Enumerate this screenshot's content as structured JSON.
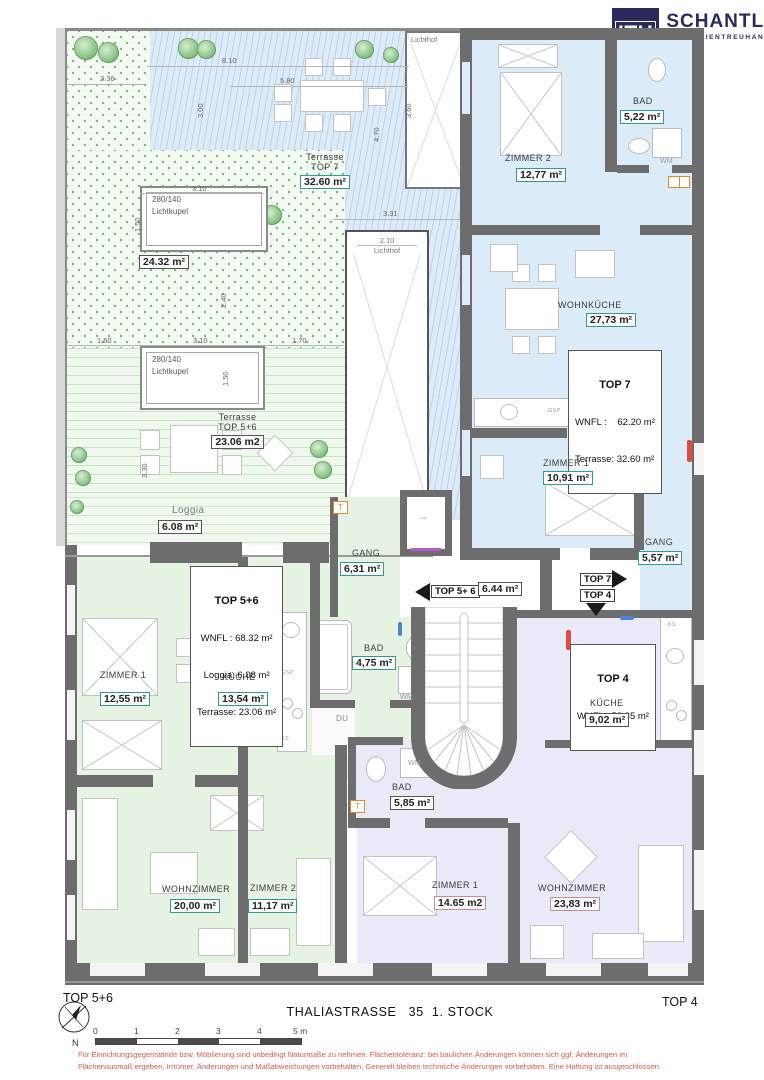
{
  "colors": {
    "wall": "#6d6d6d",
    "accent_teal": "#2f9a95",
    "logo_navy": "#2a2a5c",
    "top7_fill": "#dcebf8",
    "top56_fill": "#e6f3e3",
    "top4_fill": "#e9e9f7",
    "disclaimer_red": "#d95b52"
  },
  "logo": {
    "mark": "ITH",
    "name": "SCHANTL",
    "tagline": "IMMOBILIENTREUHAND"
  },
  "outdoor": {
    "terrasse7": {
      "line1": "Terrasse",
      "line2": "TOP 7",
      "area": "32.60 m²"
    },
    "garden_area": "24.32 m²",
    "lichtkupel1": {
      "size": "280/140",
      "name": "Lichtkupel"
    },
    "lichtkupel2": {
      "size": "280/140",
      "name": "Lichtkupel"
    },
    "lichthof1": "Lichthof",
    "lichthof2": {
      "width": "2.10",
      "name": "Lichthof"
    },
    "terrasse56": {
      "line1": "Terrasse",
      "line2": "TOP 5+6",
      "area": "23.06 m2"
    },
    "loggia": {
      "name": "Loggia",
      "area": "6.08 m²"
    }
  },
  "dims": {
    "garden_w": "2.36",
    "terr_w": "8.10",
    "table_w": "5.80",
    "terr_h": "3.00",
    "terr_h2": "4.70",
    "lh1_h": "3.60",
    "lk1_w": "3.10",
    "lk1_h": "1.50",
    "gap_h": "2.40",
    "row_l": "1.60",
    "row_m": "3.10",
    "row_r": "1.70",
    "lk2_h": "1.50",
    "right_w": "3.31",
    "terr56_h": "3.30"
  },
  "top7": {
    "info": {
      "title": "TOP 7",
      "wnfl": "WNFL :    62.20 m²",
      "terrasse": "Terrasse: 32.60 m²"
    },
    "zimmer2": {
      "label": "ZIMMER 2",
      "area": "12,77 m²"
    },
    "bad": {
      "label": "BAD",
      "area": "5,22 m²"
    },
    "wohnkueche": {
      "label": "WOHNKÜCHE",
      "area": "27,73 m²"
    },
    "zimmer1": {
      "label": "ZIMMER 1",
      "area": "10,91 m²"
    },
    "gang": {
      "label": "GANG",
      "area": "5,57 m²"
    },
    "wm": "WM",
    "gsp": "GSP",
    "ks": "KS"
  },
  "hall": {
    "area": "6.44 m²",
    "nav_left": "TOP 5+ 6",
    "nav_top7": "TOP 7",
    "nav_top4": "TOP 4"
  },
  "top56": {
    "info": {
      "title": "TOP 5+6",
      "wnfl": "WNFL : 68.32 m²",
      "loggia": "Loggia: 6.08 m²",
      "terrasse": "Terrasse: 23.06 m²"
    },
    "gang": {
      "label": "GANG",
      "area": "6,31 m²"
    },
    "zimmer1": {
      "label": "ZIMMER 1",
      "area": "12,55 m²"
    },
    "kueche": {
      "label": "KÜCHE",
      "area": "13,54 m²"
    },
    "bad": {
      "label": "BAD",
      "area": "4,75 m²"
    },
    "wohnzimmer": {
      "label": "WOHNZIMMER",
      "area": "20,00 m²"
    },
    "zimmer2": {
      "label": "ZIMMER 2",
      "area": "11,17 m²"
    },
    "du": "DU",
    "wm": "WM",
    "gsp": "GSP",
    "ks": "KS",
    "t": "T"
  },
  "top4": {
    "info": {
      "title": "TOP 4",
      "wnfl": "WNFL : 53.35 m²"
    },
    "kueche": {
      "label": "KÜCHE",
      "area": "9,02 m²"
    },
    "bad": {
      "label": "BAD",
      "area": "5,85 m²"
    },
    "zimmer1": {
      "label": "ZIMMER 1",
      "area": "14.65 m2"
    },
    "wohnzimmer": {
      "label": "WOHNZIMMER",
      "area": "23,83 m²"
    },
    "wm": "WM",
    "ks": "KS",
    "t": "T"
  },
  "footer": {
    "left": "TOP 5+6",
    "right": "TOP 4",
    "title": "THALIASTRASSE   35  1. STOCK",
    "north": "N",
    "scale": [
      "0",
      "1",
      "2",
      "3",
      "4",
      "5 m"
    ],
    "disclaimer1": "Für Einrichtungsgegenstände bzw. Möblierung sind unbedingt Naturmaße zu nehmen.  Flächentoleranz: bei baulichen Änderungen können sich ggf. Änderungen im",
    "disclaimer2": "Flächenausmaß ergeben. Irrtümer, Änderungen und Maßabweichungen vorbehalten. Generell bleiben technische Änderungen vorbehalten. Eine Haftung ist ausgeschlossen."
  }
}
